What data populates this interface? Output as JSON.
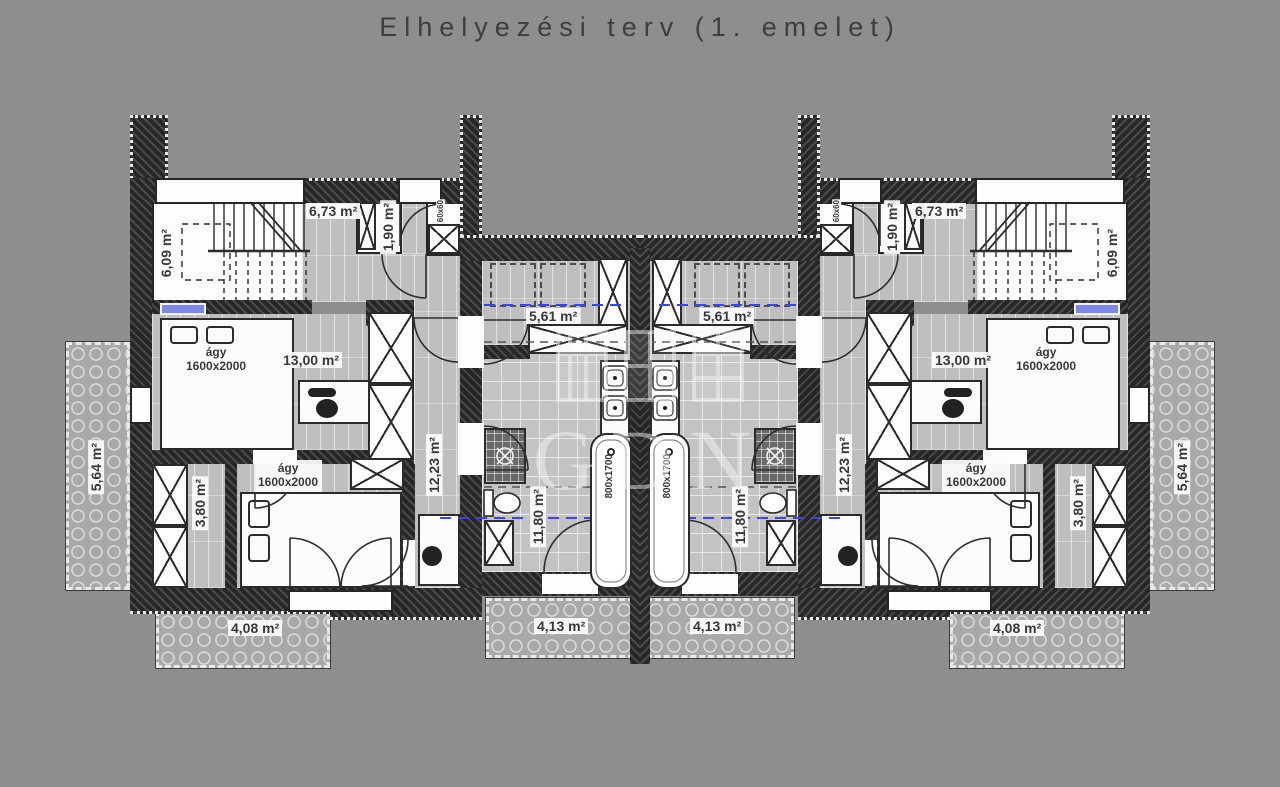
{
  "title": "Elhelyezési terv (1. emelet)",
  "watermark": {
    "text": "GDN"
  },
  "room_labels": {
    "staircase": "6,09 m²",
    "hall": "6,73 m²",
    "wc": "1,90 m²",
    "bedroom_large": "13,00 m²",
    "dressing": "5,61 m²",
    "corridor": "12,23 m²",
    "bathroom": "11,80 m²",
    "wardrobe": "3,80 m²",
    "balcony_side": "5,64 m²",
    "terrace_front": "4,08 m²",
    "balcony_center": "4,13 m²"
  },
  "furniture_labels": {
    "bed_name": "ágy",
    "bed_size": "1600x2000",
    "bathtub_size": "800x1700",
    "shaft_size": "60x60"
  },
  "colors": {
    "background": "#8e8e8e",
    "wall": "#262626",
    "floor": "#c2c2c2",
    "terrace": "#a9a9a9",
    "window_accent": "#7d88e6",
    "section_line": "#3b49d8",
    "label_text": "#383838"
  }
}
